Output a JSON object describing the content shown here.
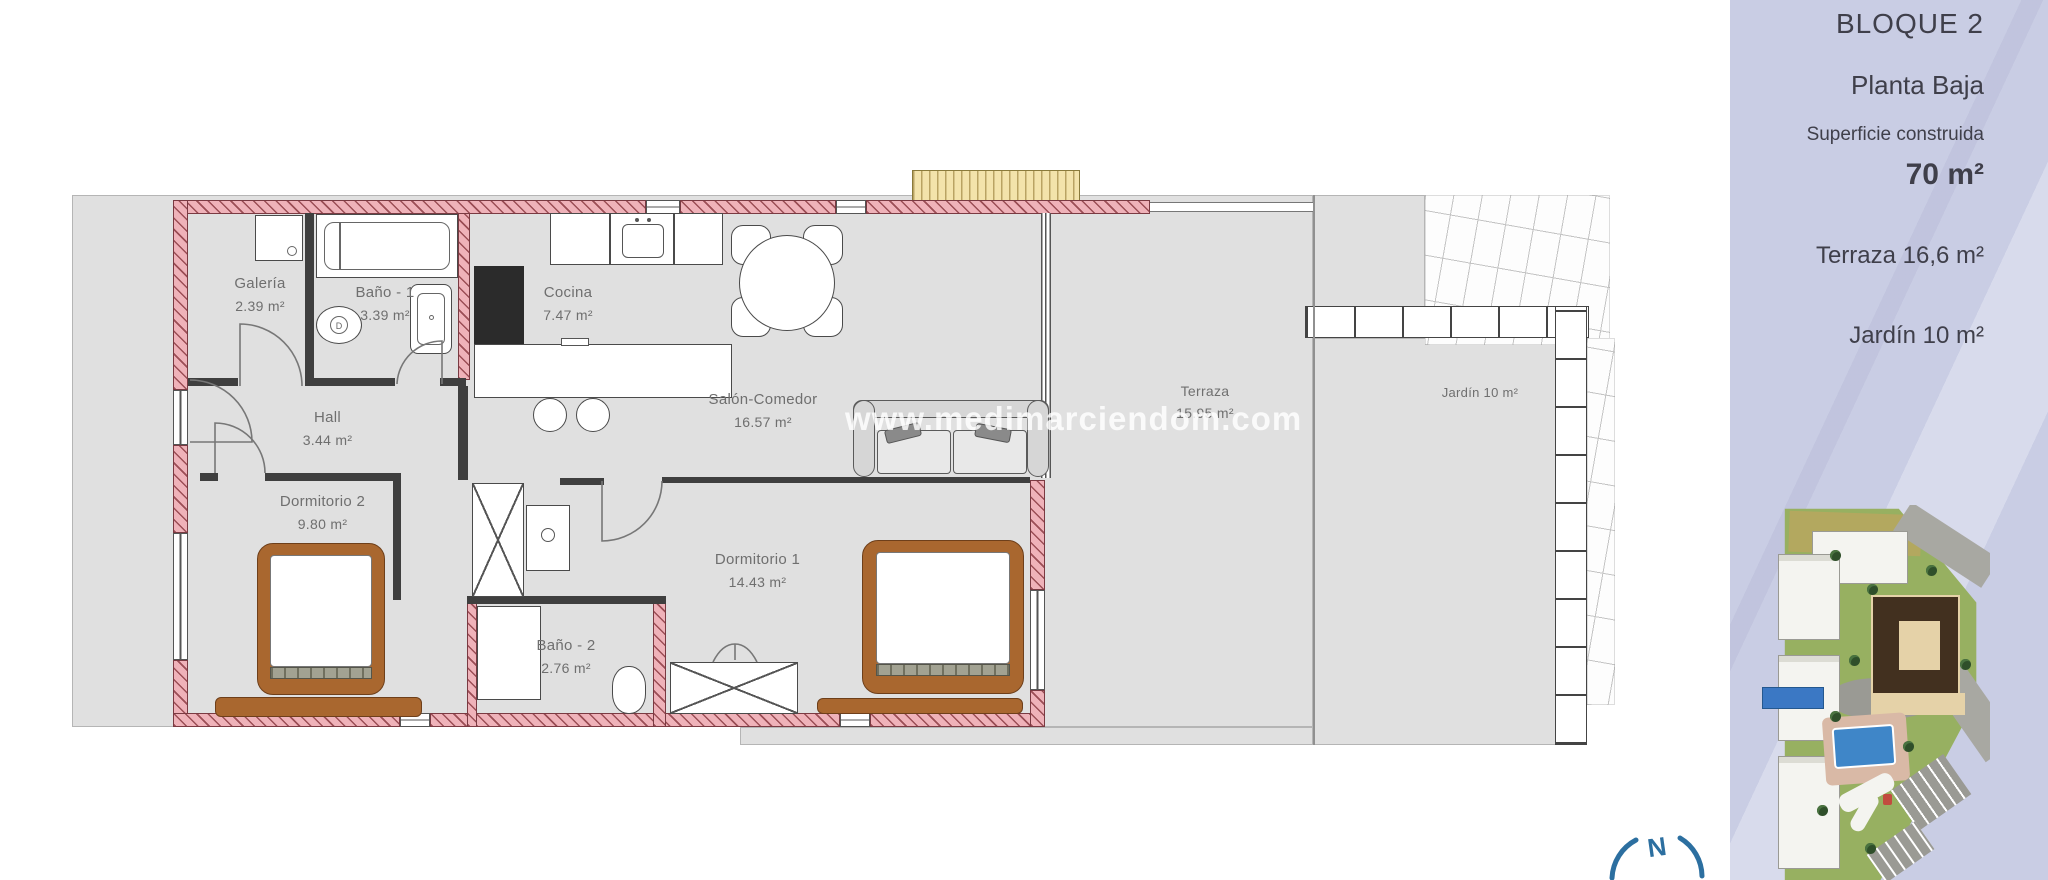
{
  "sidebar": {
    "block": "BLOQUE 2",
    "floor": "Planta Baja",
    "built_label": "Superficie construida",
    "built_value": "70 m²",
    "terrace": "Terraza 16,6 m²",
    "garden": "Jardín 10 m²"
  },
  "watermark": "www.medimarciendom.com",
  "compass": {
    "north": "N"
  },
  "plan": {
    "toilet_mark": "D",
    "rooms": [
      {
        "name": "Galería",
        "area": "2.39 m²"
      },
      {
        "name": "Baño - 1",
        "area": "3.39 m²"
      },
      {
        "name": "Cocina",
        "area": "7.47 m²"
      },
      {
        "name": "Salón-Comedor",
        "area": "16.57 m²"
      },
      {
        "name": "Hall",
        "area": "3.44 m²"
      },
      {
        "name": "Dormitorio 2",
        "area": "9.80 m²"
      },
      {
        "name": "Dormitorio 1",
        "area": "14.43 m²"
      },
      {
        "name": "Baño - 2",
        "area": "2.76 m²"
      },
      {
        "name": "Terraza",
        "area": "15.95 m²"
      },
      {
        "name": "Jardín 10 m²",
        "area": ""
      }
    ]
  },
  "colors": {
    "sidebar_lavender": "#c9cde4",
    "wall_pink": "#efb2b9",
    "floor_gray": "#e0e0e0",
    "compass_blue": "#2c6fa0",
    "bed_brown": "#a9672f",
    "awning_yellow": "#f3e3ab",
    "pool_blue": "#3f86c8",
    "unit_marker_blue": "#3b78c4"
  }
}
